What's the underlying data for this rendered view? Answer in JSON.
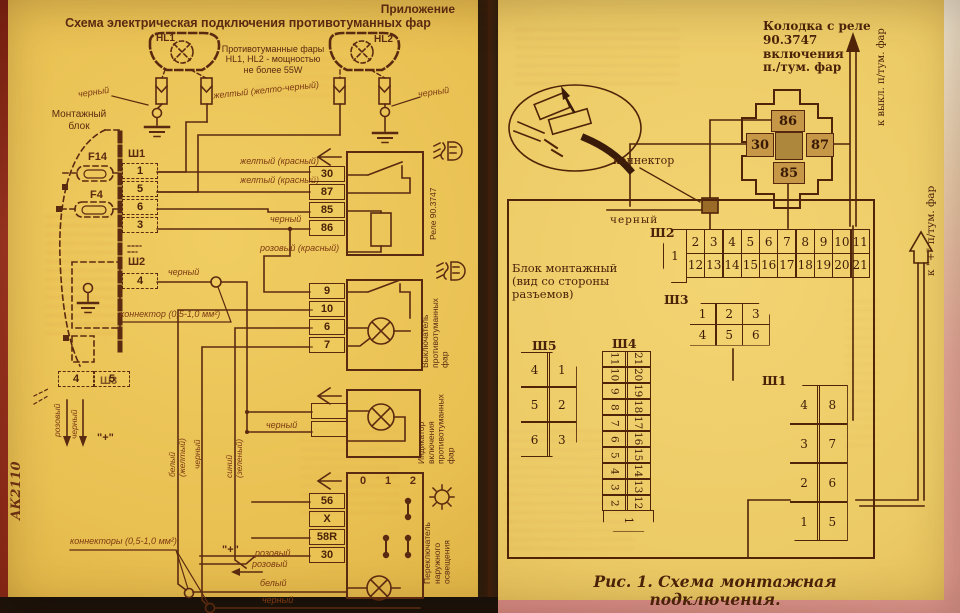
{
  "left": {
    "corner": "Приложение",
    "title": "Схема электрическая подключения противотуманных фар",
    "hl1": "HL1",
    "hl2": "HL2",
    "lamp_caption": "Противотуманные фары\nHL1, HL2 - мощностью\nне более 55W",
    "mount": "Монтажный\nблок",
    "f14": "F14",
    "f4": "F4",
    "sh1": {
      "label": "Ш1",
      "pins": [
        "1",
        "5",
        "6",
        "3"
      ]
    },
    "sh2": {
      "label": "Ш2",
      "pins": [
        "4"
      ]
    },
    "sh3": {
      "label": "Ш3",
      "pins": [
        "4",
        "5"
      ]
    },
    "relay": {
      "pins": [
        "30",
        "87",
        "85",
        "86"
      ],
      "name": "Реле 90.3747"
    },
    "switch": {
      "pins": [
        "9",
        "10",
        "6",
        "7"
      ],
      "name": "Выключатель\nпротивотуманных\nфар"
    },
    "indicator": {
      "name": "Индикатор включения\nпротивотуманных\nфар"
    },
    "light_switch": {
      "pins": [
        "56",
        "X",
        "58R",
        "30"
      ],
      "positions": [
        "0",
        "1",
        "2"
      ],
      "name": "Переключатель\nнаружного\nосвещения"
    },
    "wires": {
      "black_tl": "черный",
      "yellow_top": "желтый (желто-черный)",
      "black_tr": "черный",
      "yellow_red_1": "желтый (красный)",
      "yellow_red_2": "желтый (красный)",
      "black_relay": "черный",
      "pink_red": "розовый (красный)",
      "black_sh2": "черный",
      "black_ind": "черный",
      "pink_sh3": "розовый",
      "black_sh3": "черный",
      "white_yellow": "белый (желтый)",
      "black_mid": "черный",
      "blue_green": "синий (зеленый)",
      "pink_1": "розовый",
      "pink_2": "розовый",
      "white": "белый",
      "black_bottom": "черный"
    },
    "notes": {
      "connector": "коннектор (0,5-1,0 мм²)",
      "connectors": "коннекторы (0,5-1,0 мм²)",
      "plus": "\"+\""
    },
    "margin": "АК2110"
  },
  "right": {
    "header": "Колодка с реле\n90.3747\nвключения\nп./тум. фар",
    "pads": {
      "p86": "86",
      "p30": "30",
      "p87": "87",
      "p85": "85"
    },
    "to_switch": "к выкл. п/тум. фар",
    "to_plus": "к \"+\" п/тум. фар",
    "connector": "коннектор",
    "black": "черный",
    "block_label": "Блок монтажный\n(вид со стороны\nразъемов)",
    "sh2": {
      "label": "Ш2",
      "pin1": "1",
      "top": [
        "2",
        "3",
        "4",
        "5",
        "6",
        "7",
        "8",
        "9",
        "10",
        "11"
      ],
      "bottom": [
        "12",
        "13",
        "14",
        "15",
        "16",
        "17",
        "18",
        "19",
        "20",
        "21"
      ]
    },
    "sh3": {
      "label": "Ш3",
      "top": [
        "1",
        "2",
        "3"
      ],
      "bottom": [
        "4",
        "5",
        "6"
      ]
    },
    "sh5": {
      "label": "Ш5",
      "left": [
        "4",
        "5",
        "6"
      ],
      "right": [
        "1",
        "2",
        "3"
      ]
    },
    "sh4": {
      "label": "Ш4",
      "pin1": "1",
      "colA": [
        "11",
        "10",
        "9",
        "8",
        "7",
        "6",
        "5",
        "4",
        "3",
        "2"
      ],
      "colB": [
        "21",
        "20",
        "19",
        "18",
        "17",
        "16",
        "15",
        "14",
        "13",
        "12"
      ]
    },
    "sh1": {
      "label": "Ш1",
      "left": [
        "4",
        "3",
        "2",
        "1"
      ],
      "right": [
        "8",
        "7",
        "6",
        "5"
      ]
    },
    "caption": "Рис. 1. Схема монтажная подключения."
  }
}
